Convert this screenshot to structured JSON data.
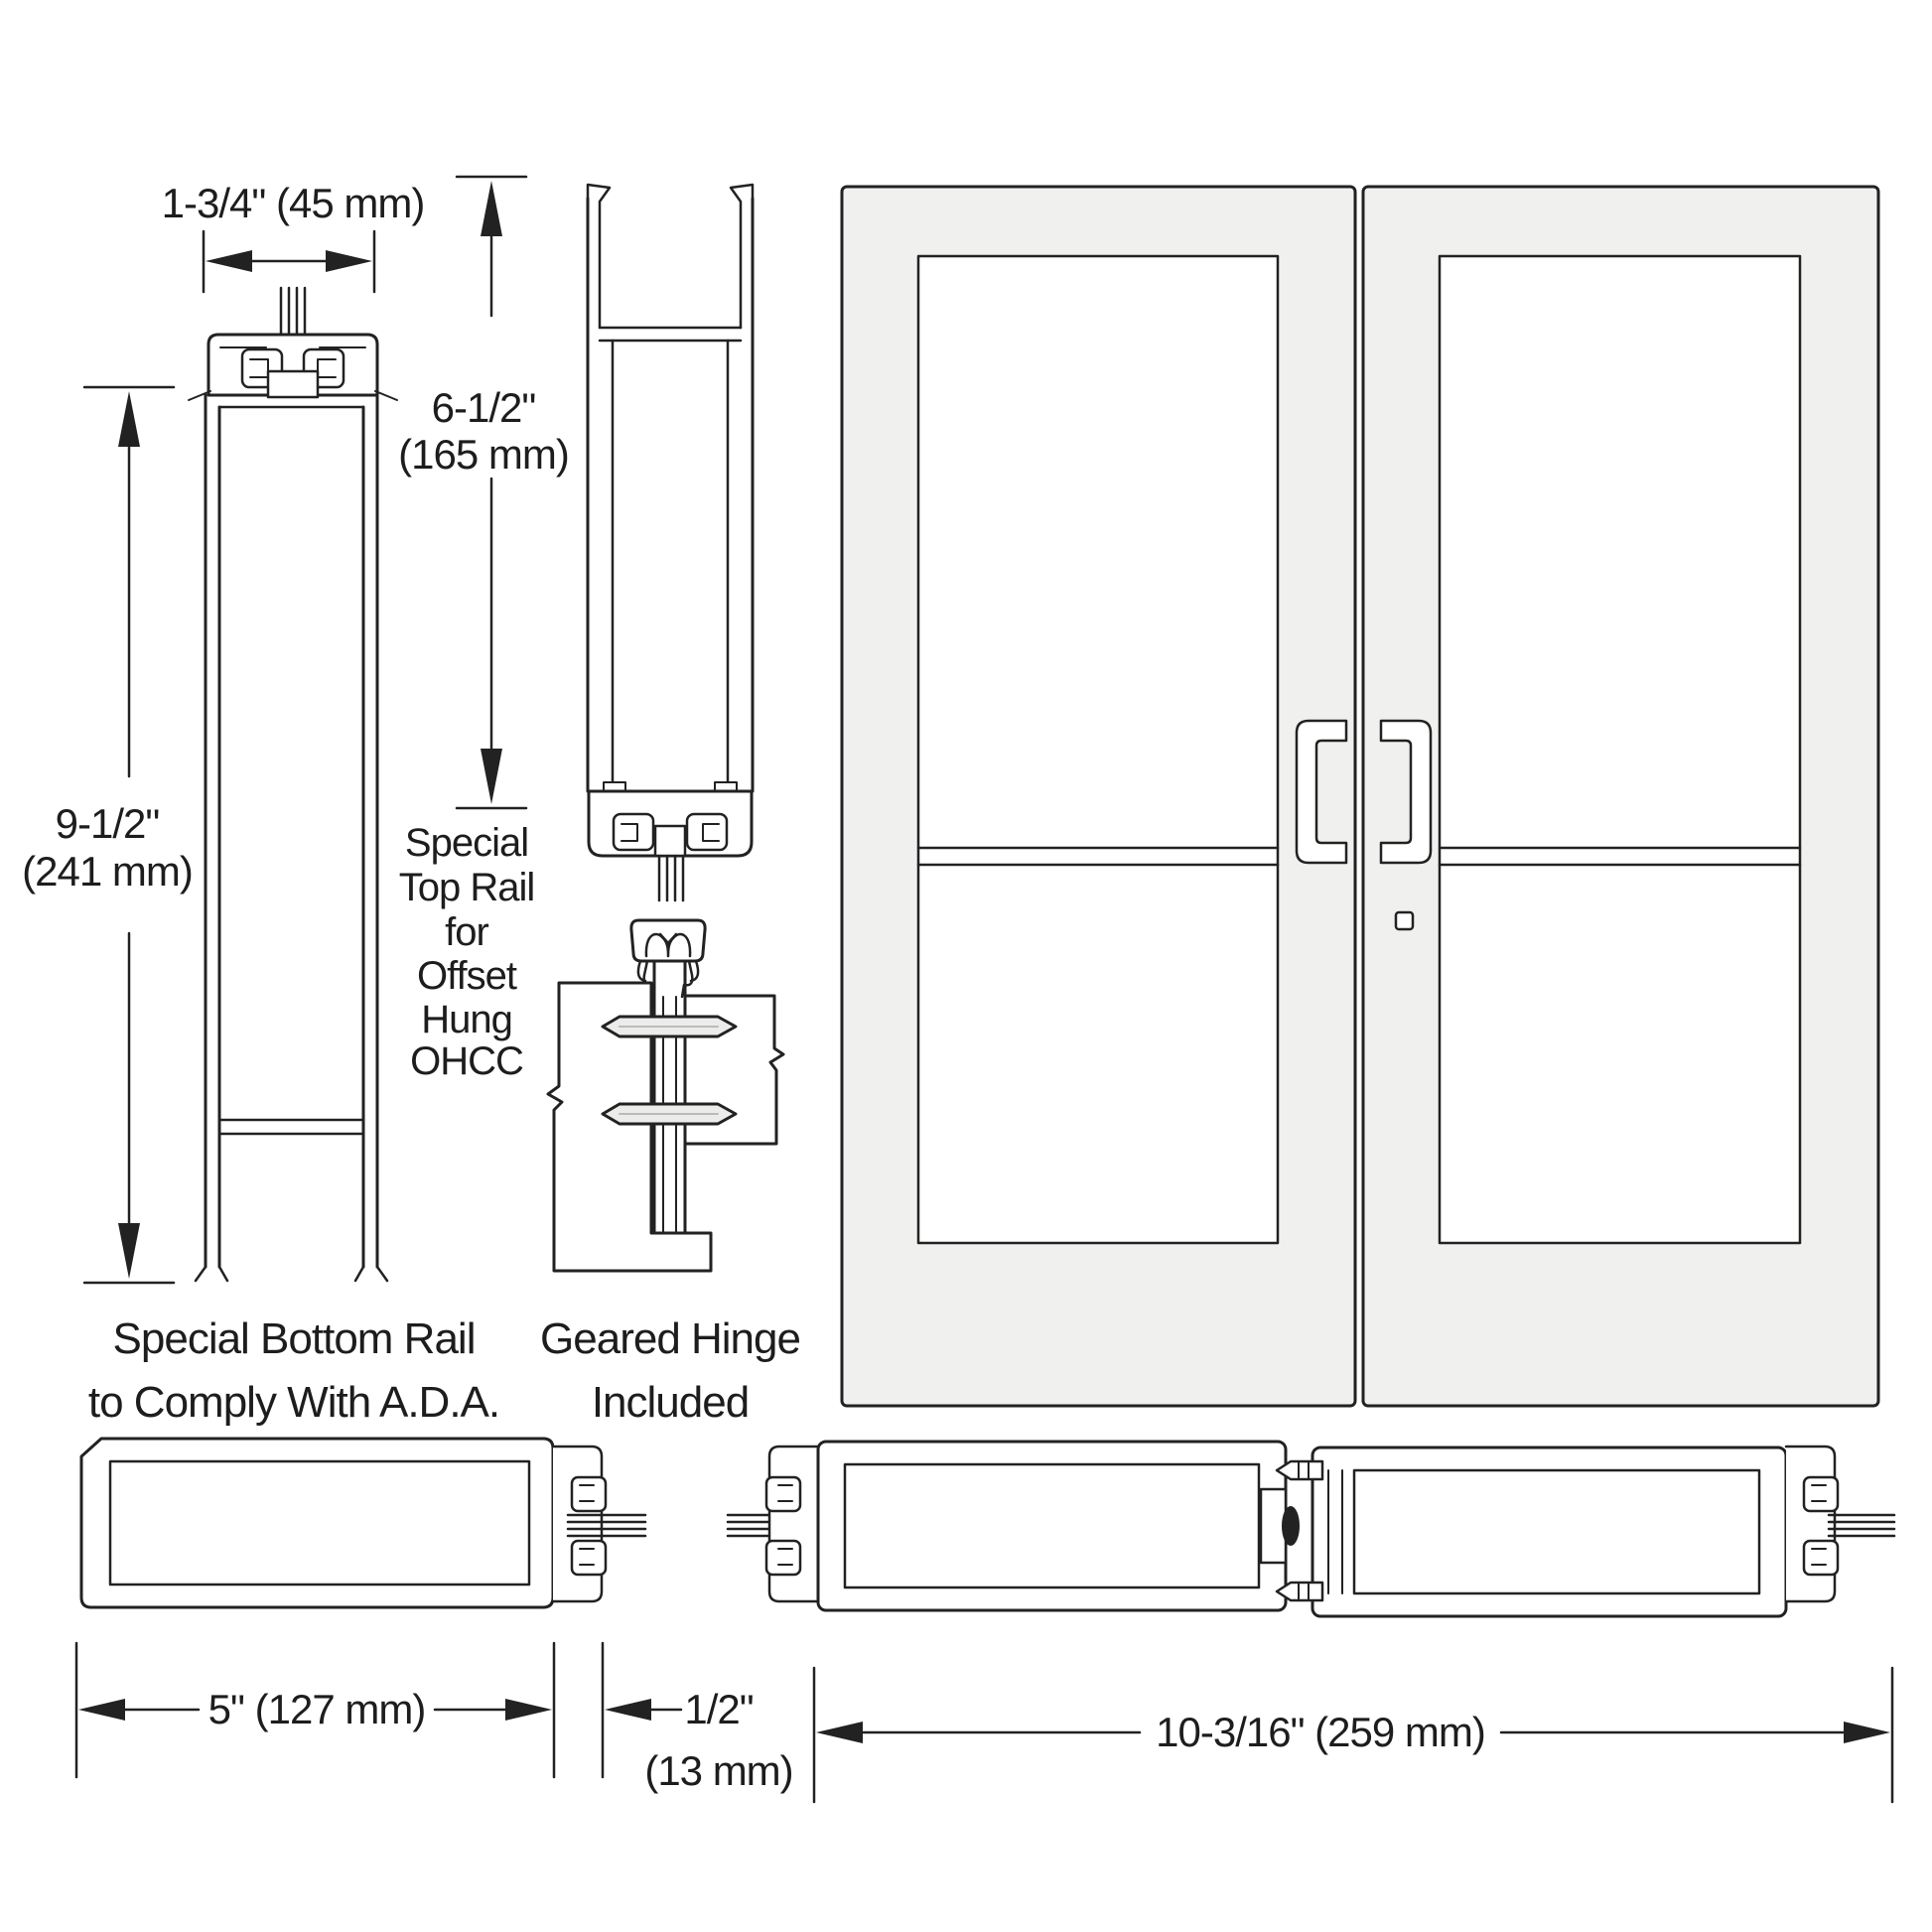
{
  "drawing": {
    "type": "door-hardware-spec-diagram",
    "colors": {
      "line": "#222222",
      "door_fill": "#f0f0ee",
      "glass_fill": "#ffffff",
      "pin_fill": "#ececea",
      "background": "#ffffff"
    }
  },
  "dimensions": {
    "stile_width": "1-3/4\" (45 mm)",
    "top_rail": [
      "6-1/2\"",
      "(165 mm)"
    ],
    "bottom_rail": [
      "9-1/2\"",
      "(241 mm)"
    ],
    "lock_stile_width": "5\" (127 mm)",
    "glass_gap": [
      "1/2\"",
      "(13 mm)"
    ],
    "hinge_stile_pair_width": "10-3/16\" (259 mm)"
  },
  "captions": {
    "top_rail_note": [
      "Special",
      "Top Rail",
      "for",
      "Offset",
      "Hung",
      "OHCC"
    ],
    "bottom_rail_note": [
      "Special Bottom Rail",
      "to Comply With A.D.A."
    ],
    "hinge_note": [
      "Geared Hinge",
      "Included"
    ]
  }
}
